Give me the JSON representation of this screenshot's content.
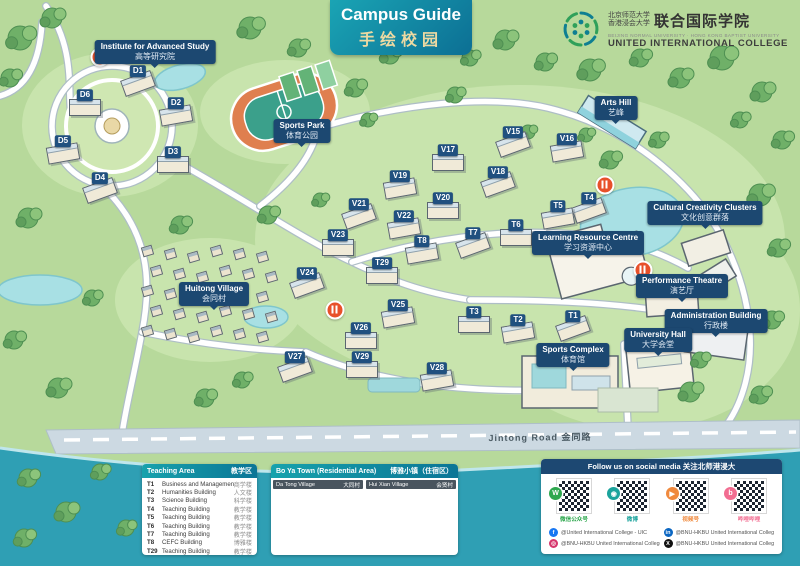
{
  "header": {
    "banner": {
      "title_en": "Campus Guide",
      "title_zh": "手绘校园"
    },
    "logo": {
      "org_zh_line1": "北京师范大学",
      "org_zh_line2": "香港浸会大学",
      "org_zh_main": "联合国际学院",
      "org_en_small": "BEIJING NORMAL UNIVERSITY · HONG KONG BAPTIST UNIVERSITY",
      "org_en_main": "UNITED INTERNATIONAL COLLEGE"
    }
  },
  "map": {
    "road_label": "Jintong Road  金同路",
    "tags": [
      {
        "id": "institute-advanced-study",
        "x": 155,
        "y": 52,
        "en": "Institute for Advanced Study",
        "zh": "高等研究院"
      },
      {
        "id": "sports-park",
        "x": 302,
        "y": 131,
        "en": "Sports Park",
        "zh": "体育公园"
      },
      {
        "id": "arts-hill",
        "x": 616,
        "y": 108,
        "en": "Arts Hill",
        "zh": "艺峰"
      },
      {
        "id": "cultural-creativity",
        "x": 705,
        "y": 213,
        "en": "Cultural Creativity Clusters",
        "zh": "文化创意群落"
      },
      {
        "id": "learning-resource-centre",
        "x": 588,
        "y": 243,
        "en": "Learning Resource Centre",
        "zh": "学习资源中心"
      },
      {
        "id": "performance-theatre",
        "x": 682,
        "y": 286,
        "en": "Performance Theatre",
        "zh": "演艺厅"
      },
      {
        "id": "administration-building",
        "x": 716,
        "y": 321,
        "en": "Administration Building",
        "zh": "行政楼"
      },
      {
        "id": "university-hall",
        "x": 658,
        "y": 340,
        "en": "University Hall",
        "zh": "大学会堂"
      },
      {
        "id": "sports-complex",
        "x": 573,
        "y": 355,
        "en": "Sports Complex",
        "zh": "体育馆"
      },
      {
        "id": "huitong-village",
        "x": 214,
        "y": 294,
        "en": "Huitong Village",
        "zh": "会同村"
      }
    ],
    "badges": [
      {
        "code": "D1",
        "x": 138,
        "y": 71
      },
      {
        "code": "D2",
        "x": 176,
        "y": 103
      },
      {
        "code": "D3",
        "x": 173,
        "y": 152
      },
      {
        "code": "D4",
        "x": 100,
        "y": 178
      },
      {
        "code": "D5",
        "x": 63,
        "y": 141
      },
      {
        "code": "D6",
        "x": 85,
        "y": 95
      },
      {
        "code": "V15",
        "x": 513,
        "y": 132
      },
      {
        "code": "V16",
        "x": 567,
        "y": 139
      },
      {
        "code": "V17",
        "x": 448,
        "y": 150
      },
      {
        "code": "V18",
        "x": 498,
        "y": 172
      },
      {
        "code": "V19",
        "x": 400,
        "y": 176
      },
      {
        "code": "V20",
        "x": 443,
        "y": 198
      },
      {
        "code": "V21",
        "x": 359,
        "y": 204
      },
      {
        "code": "V22",
        "x": 404,
        "y": 216
      },
      {
        "code": "V23",
        "x": 338,
        "y": 235
      },
      {
        "code": "V24",
        "x": 307,
        "y": 273
      },
      {
        "code": "V25",
        "x": 398,
        "y": 305
      },
      {
        "code": "V26",
        "x": 361,
        "y": 328
      },
      {
        "code": "V27",
        "x": 295,
        "y": 357
      },
      {
        "code": "V28",
        "x": 437,
        "y": 368
      },
      {
        "code": "V29",
        "x": 362,
        "y": 357
      },
      {
        "code": "T1",
        "x": 573,
        "y": 316
      },
      {
        "code": "T2",
        "x": 518,
        "y": 320
      },
      {
        "code": "T3",
        "x": 474,
        "y": 312
      },
      {
        "code": "T4",
        "x": 589,
        "y": 198
      },
      {
        "code": "T5",
        "x": 558,
        "y": 206
      },
      {
        "code": "T6",
        "x": 516,
        "y": 225
      },
      {
        "code": "T7",
        "x": 473,
        "y": 233
      },
      {
        "code": "T8",
        "x": 422,
        "y": 241
      },
      {
        "code": "T29",
        "x": 382,
        "y": 263
      }
    ],
    "pois": [
      {
        "x": 100,
        "y": 57
      },
      {
        "x": 335,
        "y": 310
      },
      {
        "x": 605,
        "y": 185
      },
      {
        "x": 643,
        "y": 270
      }
    ]
  },
  "legend": {
    "teaching": {
      "title_en": "Teaching Area",
      "title_zh": "教学区",
      "rows": [
        {
          "code": "T1",
          "en": "Business and Management Building",
          "zh": "商学楼"
        },
        {
          "code": "T2",
          "en": "Humanities Building",
          "zh": "人文楼"
        },
        {
          "code": "T3",
          "en": "Science Building",
          "zh": "科学楼"
        },
        {
          "code": "T4",
          "en": "Teaching Building",
          "zh": "教学楼"
        },
        {
          "code": "T5",
          "en": "Teaching Building",
          "zh": "教学楼"
        },
        {
          "code": "T6",
          "en": "Teaching Building",
          "zh": "教学楼"
        },
        {
          "code": "T7",
          "en": "Teaching Building",
          "zh": "教学楼"
        },
        {
          "code": "T8",
          "en": "CEFC Building",
          "zh": "博雅楼"
        },
        {
          "code": "T29",
          "en": "Teaching Building",
          "zh": "教学楼"
        }
      ]
    },
    "residential": {
      "title_en": "Bo Ya Town (Residential Area)",
      "title_zh": "博雅小镇（住宿区）",
      "villages": [
        {
          "name_en": "Da Tong Village",
          "name_zh": "大同村",
          "rows": [
            {
              "code": "V15",
              "en": "Ming Xin House",
              "zh": "明心楼"
            },
            {
              "code": "V16",
              "en": "Shang Xian House",
              "zh": "尚贤楼"
            },
            {
              "code": "V17",
              "en": "Ren Ai House",
              "zh": "仁爱楼"
            },
            {
              "code": "V18",
              "en": "Bao Pu House",
              "zh": "抱朴楼"
            },
            {
              "code": "V19",
              "en": "Zhen Zhi House",
              "zh": "真知楼"
            },
            {
              "code": "V20",
              "en": "Du Xing House",
              "zh": "笃行楼"
            },
            {
              "code": "V21",
              "en": "Bo Wen House",
              "zh": "博文楼"
            },
            {
              "code": "V22",
              "en": "Ya Zhi House",
              "zh": "雅致楼"
            }
          ]
        },
        {
          "name_en": "Hui Xian Village",
          "name_zh": "会贤村",
          "rows": [
            {
              "code": "V23",
              "en": "Xue Qin House",
              "zh": "雪琴楼"
            },
            {
              "code": "V24",
              "en": "Yang Ming House",
              "zh": "阳明楼"
            },
            {
              "code": "V25",
              "en": "Dong Po House",
              "zh": "东坡楼"
            },
            {
              "code": "V26",
              "en": "Goethe House",
              "zh": "歌德楼"
            },
            {
              "code": "V27",
              "en": "Hugo House",
              "zh": "雨果楼"
            },
            {
              "code": "V28",
              "en": "Shakespeare House",
              "zh": "莎翁楼"
            },
            {
              "code": "V29",
              "en": "Yung Wing House",
              "zh": "容闳楼"
            }
          ]
        }
      ]
    },
    "social": {
      "title": "Follow us on social media   关注北师港浸大",
      "qrs": [
        {
          "platform": "wechat",
          "glyph": "W",
          "label": "微信公众号",
          "color": "#2fa84f"
        },
        {
          "platform": "weibo",
          "glyph": "◉",
          "label": "微博",
          "color": "#1ba39c"
        },
        {
          "platform": "wechat-channels",
          "glyph": "▶",
          "label": "视频号",
          "color": "#f08a3e"
        },
        {
          "platform": "bilibili",
          "glyph": "b",
          "label": "哔哩哔哩",
          "color": "#f26d91"
        }
      ],
      "accounts": [
        {
          "platform": "facebook",
          "glyph": "f",
          "color": "#1877f2",
          "handle": "@United International College - UIC"
        },
        {
          "platform": "linkedin",
          "glyph": "in",
          "color": "#0a66c2",
          "handle": "@BNU-HKBU United International College"
        },
        {
          "platform": "instagram",
          "glyph": "◎",
          "color": "#d6366c",
          "handle": "@BNU-HKBU United International College"
        },
        {
          "platform": "x",
          "glyph": "X",
          "color": "#111111",
          "handle": "@BNU-HKBU United International College"
        }
      ]
    }
  },
  "colors": {
    "map_background": "#b7d99b",
    "label_navy": "#1c4871",
    "header_teal": "#17a2ac",
    "river_teal": "#2f9fb4",
    "track_orange": "#df7f4f",
    "dining_red": "#e8502a"
  }
}
